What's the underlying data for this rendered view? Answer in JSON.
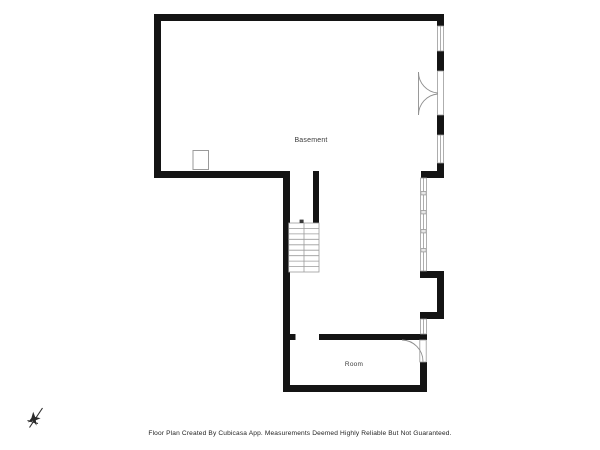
{
  "plan": {
    "floor_label": "Basement",
    "room_label": "Room"
  },
  "footer": {
    "disclaimer": "Floor Plan Created By Cubicasa App. Measurements Deemed Highly Reliable But Not Guaranteed."
  },
  "icons": {
    "north_icon": "north-arrow-icon"
  },
  "colors": {
    "background": "#ffffff",
    "wall": "#141414",
    "window_frame": "#999999",
    "stair_line": "#9c9c9c",
    "door_arc": "#8f8f8f",
    "label_text": "#3c3c3c",
    "footer_text": "#1e1e1e"
  }
}
